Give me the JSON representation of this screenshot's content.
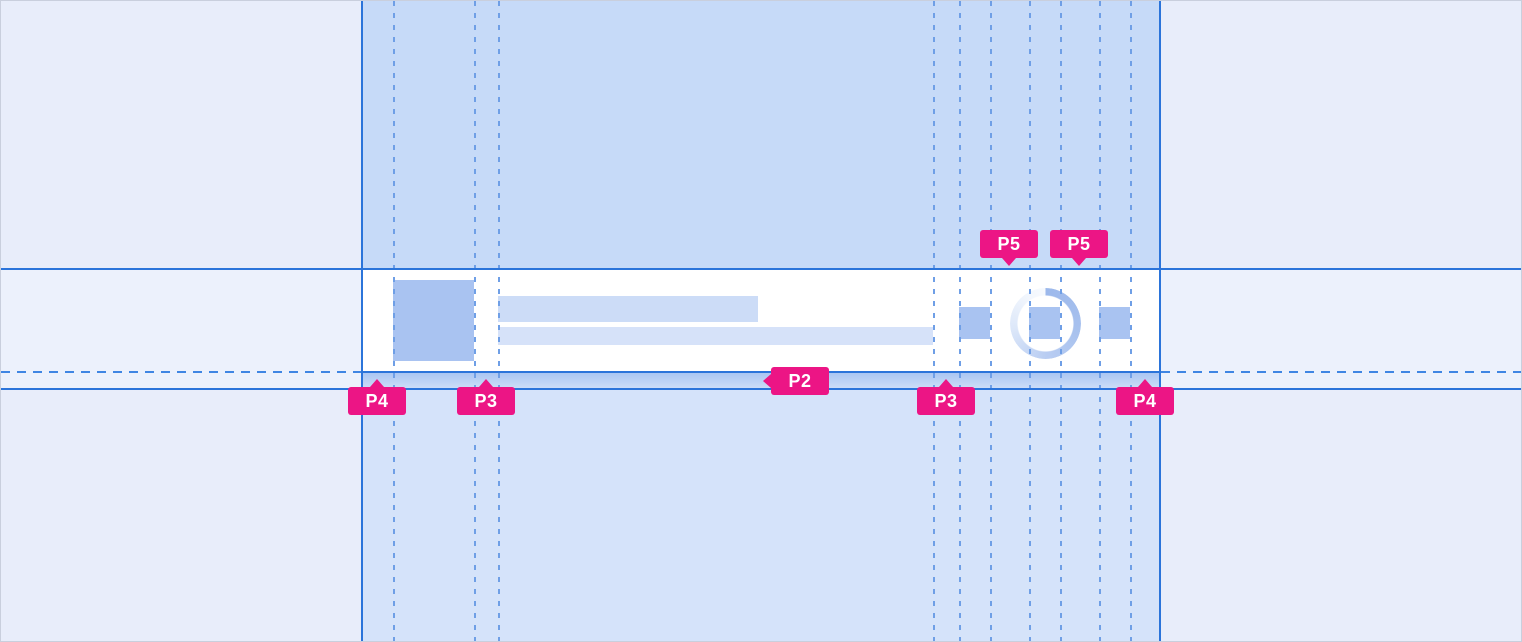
{
  "annotation": {
    "p2": "P2",
    "p3": "P3",
    "p4": "P4",
    "p5": "P5"
  },
  "colors": {
    "outside": "#e8edfa",
    "middle-band": "#ecf1fc",
    "column-top": "#c6daf8",
    "column-bottom": "#d5e3fa",
    "row-bg": "#ffffff",
    "strip-from": "#a9c5f2",
    "strip-to": "#cddef8",
    "line": "#2b74da",
    "guide": "#6f9fe6",
    "guide-strong": "#3f85e3",
    "placeholder-fill": "#a9c3f1",
    "bar1-fill": "#ccdcf7",
    "bar2-fill": "#d6e2f9",
    "accent-pink": "#ec1585",
    "label-text": "#ffffff"
  }
}
